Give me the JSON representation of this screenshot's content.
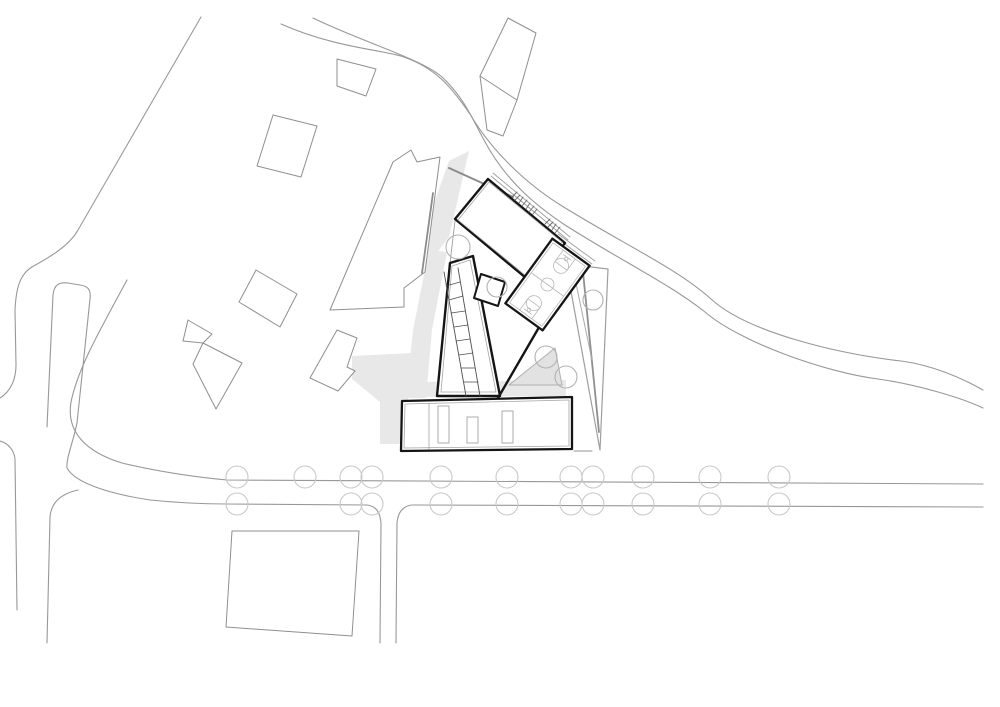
{
  "scene": {
    "kind": "architectural-site-plan",
    "width": 1000,
    "height": 707,
    "background": "#ffffff"
  },
  "palette": {
    "paper": "#ffffff",
    "road": "#989898",
    "context": "#8f8f8f",
    "wall_gray": "#8c8c8c",
    "kite": "#9e9e9e",
    "kite_heavy": "#8f8f8f",
    "kite_light": "#ababab",
    "shadow": "#e8e8e8",
    "plaza_fill": "#e2e2e2",
    "plaza_edge": "#b0b0b0",
    "dark": "#151515",
    "inner": "#a5a5a5",
    "marking": "#b8b8b8",
    "detail": "#4f4f4f",
    "stair": "#6a6a6a",
    "terrace": "#9d9d9d",
    "site_tree": "#b2b2b2",
    "street_tree": "#c9c9c9",
    "white": "#ffffff",
    "none": "none"
  },
  "layers": [
    {
      "kind": "polygon",
      "name": "shadow-upper-west",
      "points": "449,161 469,151 449,237 429,263 424,231",
      "fill": "shadow",
      "stroke": "none"
    },
    {
      "kind": "polygon",
      "name": "shadow-wing-west",
      "points": "429,250 447,252 432,330 426,398 406,398 413,330",
      "fill": "shadow",
      "stroke": "none"
    },
    {
      "kind": "polygon",
      "name": "shadow-lower-west",
      "points": "352,356 412,353 404,444 380,444 380,402 352,379",
      "fill": "shadow",
      "stroke": "none"
    },
    {
      "kind": "polygon",
      "name": "shadow-courtyard-band",
      "points": "415,382 566,380 566,396 413,397",
      "fill": "shadow",
      "stroke": "none"
    },
    {
      "kind": "path",
      "name": "road-northwest-boundary",
      "d": "M 201,17 L 78,230 C 68,248 44,260 32,267 C 19,275 16,290 15,310 L 16,365 C 16,380 10,392 0,398",
      "stroke": "road",
      "w": 1.1
    },
    {
      "kind": "path",
      "name": "road-main-outer-edge",
      "d": "M 281,24 C 335,48 385,50 404,57 C 437,69 450,86 470,114 C 492,152 528,185 562,206 C 625,245 678,269 711,299 C 748,333 840,354 901,361 C 932,365 962,378 983,390",
      "stroke": "road",
      "w": 1.1
    },
    {
      "kind": "path",
      "name": "road-main-inner-edge",
      "d": "M 313,18 C 362,42 425,60 443,78 C 464,98 472,118 484,140 C 505,180 535,205 565,225 C 625,263 668,283 705,312 C 740,342 824,372 878,379 C 914,384 960,397 983,408",
      "stroke": "road",
      "w": 1.1
    },
    {
      "kind": "path",
      "name": "street-north-edge",
      "d": "M 127,280 C 100,330 78,368 71,402 C 66,432 86,452 122,463 C 160,472 195,477 227,480 L 983,484",
      "stroke": "road",
      "w": 1.1
    },
    {
      "kind": "path",
      "name": "street-south-edge-west",
      "d": "M 77,423 C 73,443 66,458 67,468 C 75,483 110,494 150,500 C 180,503 205,504 227,504 L 367,505",
      "stroke": "road",
      "w": 1.1
    },
    {
      "kind": "path",
      "name": "street-south-edge-east",
      "d": "M 412,505 L 983,507",
      "stroke": "road",
      "w": 1.1
    },
    {
      "kind": "path",
      "name": "traffic-island",
      "d": "M 47,427 L 53,295 C 54,284 60,282 68,283 L 80,285 C 89,286 91,291 90,299 L 77,423",
      "stroke": "road",
      "w": 1.1
    },
    {
      "kind": "path",
      "name": "road-left-curb",
      "d": "M 0,441 C 8,443 14,450 15,459 L 17,610",
      "stroke": "road",
      "w": 1.1
    },
    {
      "kind": "path",
      "name": "road-southwest-branch",
      "d": "M 78,490 C 60,494 51,503 50,517 L 47,643",
      "stroke": "road",
      "w": 1.1
    },
    {
      "kind": "path",
      "name": "road-south-branch-west",
      "d": "M 367,505 C 376,506 380,512 381,523 L 380,643",
      "stroke": "road",
      "w": 1.1
    },
    {
      "kind": "path",
      "name": "road-south-branch-east",
      "d": "M 412,505 C 403,506 398,512 397,523 L 396,643",
      "stroke": "road",
      "w": 1.1
    },
    {
      "kind": "polygon",
      "name": "context-building-1",
      "points": "337,59 376,69 366,96 337,86",
      "fill": "white",
      "stroke": "context",
      "w": 1
    },
    {
      "kind": "polygon",
      "name": "context-building-2",
      "points": "273,115 317,126 301,177 257,166",
      "fill": "white",
      "stroke": "context",
      "w": 1
    },
    {
      "kind": "polygon",
      "name": "context-building-long",
      "points": "393,162 411,150 417,162 440,157 425,272 404,288 404,307 330,310",
      "fill": "white",
      "stroke": "context",
      "w": 1
    },
    {
      "kind": "polygon",
      "name": "context-building-4",
      "points": "256,270 297,294 280,327 239,302",
      "fill": "white",
      "stroke": "context",
      "w": 1
    },
    {
      "kind": "polygon",
      "name": "context-building-5a",
      "points": "188,320 212,334 203,343 183,341",
      "fill": "white",
      "stroke": "context",
      "w": 1
    },
    {
      "kind": "polygon",
      "name": "context-building-5b",
      "points": "203,343 242,363 216,409 193,364",
      "fill": "white",
      "stroke": "context",
      "w": 1
    },
    {
      "kind": "polygon",
      "name": "context-building-6",
      "points": "337,330 357,338 347,367 355,371 338,391 310,378",
      "fill": "white",
      "stroke": "context",
      "w": 1
    },
    {
      "kind": "polygon",
      "name": "context-building-tall",
      "points": "508,18 536,33 517,100 503,136 487,130 480,76",
      "fill": "white",
      "stroke": "context",
      "w": 1
    },
    {
      "kind": "line",
      "name": "context-building-tall-divider",
      "x1": 480,
      "y1": 76,
      "x2": 517,
      "y2": 100,
      "stroke": "context",
      "w": 1
    },
    {
      "kind": "polygon",
      "name": "context-parcel-south",
      "points": "232,531 359,531 352,636 226,627",
      "fill": "white",
      "stroke": "context",
      "w": 1
    },
    {
      "kind": "line",
      "name": "retaining-wall-north",
      "x1": 449,
      "y1": 168,
      "x2": 513,
      "y2": 197,
      "stroke": "wall_gray",
      "w": 2
    },
    {
      "kind": "line",
      "name": "retaining-wall-west",
      "x1": 433,
      "y1": 193,
      "x2": 422,
      "y2": 273,
      "stroke": "wall_gray",
      "w": 1.8
    },
    {
      "kind": "line",
      "name": "curb-tick-east",
      "x1": 574,
      "y1": 451,
      "x2": 592,
      "y2": 451,
      "stroke": "kite_light",
      "w": 1.2
    },
    {
      "kind": "polygon",
      "name": "terrain-kite",
      "points": "566,264 608,269 600,450",
      "fill": "none",
      "stroke": "kite",
      "w": 1.2
    },
    {
      "kind": "line",
      "name": "terrain-kite-inner-1",
      "x1": 583,
      "y1": 272,
      "x2": 599,
      "y2": 432,
      "stroke": "kite_heavy",
      "w": 1.8
    },
    {
      "kind": "line",
      "name": "terrain-kite-inner-2",
      "x1": 573,
      "y1": 269,
      "x2": 592,
      "y2": 360,
      "stroke": "kite_light",
      "w": 1
    },
    {
      "kind": "polygon",
      "name": "plaza-triangle",
      "points": "509,385 555,348 562,385",
      "fill": "plaza_fill",
      "stroke": "plaza_edge",
      "w": 1
    },
    {
      "kind": "line",
      "name": "terrace-edge-1",
      "x1": 491,
      "y1": 176,
      "x2": 568,
      "y2": 240,
      "stroke": "terrace",
      "w": 0.9
    },
    {
      "kind": "line",
      "name": "terrace-edge-2",
      "x1": 493,
      "y1": 173,
      "x2": 570,
      "y2": 237,
      "stroke": "terrace",
      "w": 0.9
    },
    {
      "kind": "line",
      "name": "terrace-edge-3",
      "x1": 555,
      "y1": 237,
      "x2": 592,
      "y2": 264,
      "stroke": "terrace",
      "w": 0.9
    },
    {
      "kind": "line",
      "name": "terrace-edge-4",
      "x1": 558,
      "y1": 234,
      "x2": 595,
      "y2": 261,
      "stroke": "terrace",
      "w": 0.9
    },
    {
      "kind": "line",
      "name": "courtyard-link-edge",
      "x1": 455,
      "y1": 221,
      "x2": 450,
      "y2": 263,
      "stroke": "terrace",
      "w": 0.9
    },
    {
      "kind": "polygon",
      "name": "hall-building",
      "points": "488,179 565,243 532,283 455,219",
      "fill": "white",
      "stroke": "dark",
      "w": 2.4
    },
    {
      "kind": "polygon",
      "name": "hall-building-inner-wall",
      "points": "489,182 562,242 531,280 458,220",
      "fill": "none",
      "stroke": "inner",
      "w": 0.8
    },
    {
      "kind": "polygon",
      "name": "wing-building",
      "points": "450,263 473,256 500,396 437,396",
      "fill": "white",
      "stroke": "dark",
      "w": 2.4
    },
    {
      "kind": "polygon",
      "name": "wing-building-inner-wall",
      "points": "452,266 470,260 496,392 441,392",
      "fill": "none",
      "stroke": "inner",
      "w": 0.8
    },
    {
      "kind": "line",
      "name": "ramp-rail-1",
      "x1": 444,
      "y1": 272,
      "x2": 466,
      "y2": 396,
      "stroke": "detail",
      "w": 0.9
    },
    {
      "kind": "line",
      "name": "ramp-rail-2",
      "x1": 458,
      "y1": 268,
      "x2": 480,
      "y2": 396,
      "stroke": "detail",
      "w": 0.9
    },
    {
      "kind": "line",
      "name": "ramp-rung",
      "x1": 446,
      "y1": 286,
      "x2": 460,
      "y2": 282,
      "stroke": "detail",
      "w": 0.8
    },
    {
      "kind": "line",
      "name": "ramp-rung",
      "x1": 449,
      "y1": 300,
      "x2": 463,
      "y2": 296,
      "stroke": "detail",
      "w": 0.8
    },
    {
      "kind": "line",
      "name": "ramp-rung",
      "x1": 451,
      "y1": 313,
      "x2": 465,
      "y2": 311,
      "stroke": "detail",
      "w": 0.8
    },
    {
      "kind": "line",
      "name": "ramp-rung",
      "x1": 454,
      "y1": 327,
      "x2": 468,
      "y2": 325,
      "stroke": "detail",
      "w": 0.8
    },
    {
      "kind": "line",
      "name": "ramp-rung",
      "x1": 456,
      "y1": 341,
      "x2": 470,
      "y2": 339,
      "stroke": "detail",
      "w": 0.8
    },
    {
      "kind": "line",
      "name": "ramp-rung",
      "x1": 459,
      "y1": 355,
      "x2": 473,
      "y2": 353,
      "stroke": "detail",
      "w": 0.8
    },
    {
      "kind": "line",
      "name": "ramp-rung",
      "x1": 461,
      "y1": 368,
      "x2": 475,
      "y2": 368,
      "stroke": "detail",
      "w": 0.8
    },
    {
      "kind": "line",
      "name": "ramp-rung",
      "x1": 464,
      "y1": 382,
      "x2": 478,
      "y2": 382,
      "stroke": "detail",
      "w": 0.8
    },
    {
      "kind": "polygon",
      "name": "entry-pavilion",
      "points": "481,274 505,282 498,306 474,298",
      "fill": "white",
      "stroke": "dark",
      "w": 2
    },
    {
      "kind": "polygon",
      "name": "lower-building",
      "points": "402,401 572,397 572,449 401,451",
      "fill": "white",
      "stroke": "dark",
      "w": 2.3
    },
    {
      "kind": "polygon",
      "name": "lower-building-inner-wall",
      "points": "405,404 569,400 569,446 404,448",
      "fill": "none",
      "stroke": "inner",
      "w": 0.8
    },
    {
      "kind": "line",
      "name": "lower-building-divider",
      "x1": 429,
      "y1": 403,
      "x2": 429,
      "y2": 449,
      "stroke": "inner",
      "w": 0.8
    },
    {
      "kind": "rect",
      "name": "skylight-1",
      "x": 438,
      "y": 406,
      "wd": 11,
      "h": 37,
      "fill": "white",
      "stroke": "kite_light",
      "w": 1
    },
    {
      "kind": "rect",
      "name": "skylight-2",
      "x": 467,
      "y": 417,
      "wd": 11,
      "h": 26,
      "fill": "white",
      "stroke": "kite_light",
      "w": 1
    },
    {
      "kind": "rect",
      "name": "skylight-3",
      "x": 502,
      "y": 411,
      "wd": 11,
      "h": 32,
      "fill": "white",
      "stroke": "kite_light",
      "w": 1
    },
    {
      "kind": "line",
      "name": "courtyard-wall",
      "x1": 538,
      "y1": 329,
      "x2": 498,
      "y2": 398,
      "stroke": "dark",
      "w": 2.4
    },
    {
      "kind": "line",
      "name": "stair-step",
      "x1": 512,
      "y1": 197,
      "x2": 517,
      "y2": 192,
      "stroke": "stair",
      "w": 0.9
    },
    {
      "kind": "line",
      "name": "stair-step",
      "x1": 515,
      "y1": 200,
      "x2": 520,
      "y2": 195,
      "stroke": "stair",
      "w": 0.9
    },
    {
      "kind": "line",
      "name": "stair-step",
      "x1": 519,
      "y1": 203,
      "x2": 523,
      "y2": 197,
      "stroke": "stair",
      "w": 0.9
    },
    {
      "kind": "line",
      "name": "stair-step",
      "x1": 522,
      "y1": 206,
      "x2": 527,
      "y2": 200,
      "stroke": "stair",
      "w": 0.9
    },
    {
      "kind": "line",
      "name": "stair-step",
      "x1": 526,
      "y1": 209,
      "x2": 530,
      "y2": 203,
      "stroke": "stair",
      "w": 0.9
    },
    {
      "kind": "line",
      "name": "stair-step",
      "x1": 529,
      "y1": 212,
      "x2": 534,
      "y2": 206,
      "stroke": "stair",
      "w": 0.9
    },
    {
      "kind": "line",
      "name": "stair-step",
      "x1": 533,
      "y1": 214,
      "x2": 537,
      "y2": 209,
      "stroke": "stair",
      "w": 0.9
    },
    {
      "kind": "line",
      "name": "stair-step",
      "x1": 545,
      "y1": 224,
      "x2": 550,
      "y2": 219,
      "stroke": "stair",
      "w": 0.9
    },
    {
      "kind": "line",
      "name": "stair-step",
      "x1": 548,
      "y1": 227,
      "x2": 553,
      "y2": 222,
      "stroke": "stair",
      "w": 0.9
    },
    {
      "kind": "line",
      "name": "stair-step",
      "x1": 552,
      "y1": 230,
      "x2": 556,
      "y2": 224,
      "stroke": "stair",
      "w": 0.9
    },
    {
      "kind": "line",
      "name": "stair-step",
      "x1": 555,
      "y1": 233,
      "x2": 560,
      "y2": 227,
      "stroke": "stair",
      "w": 0.9
    },
    {
      "kind": "group",
      "name": "basketball-court",
      "transform": "translate(547.5,284.5) rotate(36)",
      "items": [
        {
          "kind": "rect",
          "name": "court-slab",
          "x": -23,
          "y": -40,
          "wd": 46,
          "h": 80,
          "fill": "white",
          "stroke": "dark",
          "w": 2.3
        },
        {
          "kind": "rect",
          "name": "court-boundary",
          "x": -20,
          "y": -37,
          "wd": 40,
          "h": 74,
          "fill": "none",
          "stroke": "marking",
          "w": 0.8
        },
        {
          "kind": "line",
          "name": "court-halfway-line",
          "x1": -20,
          "y1": 0,
          "x2": 20,
          "y2": 0,
          "stroke": "marking",
          "w": 0.8
        },
        {
          "kind": "circle",
          "name": "court-center-circle",
          "cx": 0,
          "cy": 0,
          "r": 6.5,
          "fill": "none",
          "stroke": "marking",
          "w": 0.8
        },
        {
          "kind": "rect",
          "name": "court-key-north",
          "x": -7.5,
          "y": -37,
          "wd": 15,
          "h": 14,
          "fill": "none",
          "stroke": "marking",
          "w": 0.8
        },
        {
          "kind": "circle",
          "name": "court-freethrow-north",
          "cx": 0,
          "cy": -23,
          "r": 7.5,
          "fill": "none",
          "stroke": "marking",
          "w": 0.8
        },
        {
          "kind": "line",
          "name": "court-backboard-north",
          "x1": -4.5,
          "y1": -33.5,
          "x2": 4.5,
          "y2": -33.5,
          "stroke": "marking",
          "w": 0.8
        },
        {
          "kind": "circle",
          "name": "court-hoop-north",
          "cx": 0,
          "cy": -31.5,
          "r": 1.8,
          "fill": "none",
          "stroke": "marking",
          "w": 0.8
        },
        {
          "kind": "rect",
          "name": "court-key-south",
          "x": -7.5,
          "y": 23,
          "wd": 15,
          "h": 14,
          "fill": "none",
          "stroke": "marking",
          "w": 0.8
        },
        {
          "kind": "circle",
          "name": "court-freethrow-south",
          "cx": 0,
          "cy": 23,
          "r": 7.5,
          "fill": "none",
          "stroke": "marking",
          "w": 0.8
        },
        {
          "kind": "line",
          "name": "court-backboard-south",
          "x1": -4.5,
          "y1": 33.5,
          "x2": 4.5,
          "y2": 33.5,
          "stroke": "marking",
          "w": 0.8
        },
        {
          "kind": "circle",
          "name": "court-hoop-south",
          "cx": 0,
          "cy": 31.5,
          "r": 1.8,
          "fill": "none",
          "stroke": "marking",
          "w": 0.8
        }
      ]
    },
    {
      "kind": "circle",
      "name": "site-tree",
      "cx": 458,
      "cy": 247,
      "r": 12,
      "fill": "none",
      "stroke": "site_tree",
      "w": 1.1
    },
    {
      "kind": "circle",
      "name": "site-tree",
      "cx": 497,
      "cy": 287,
      "r": 10,
      "fill": "none",
      "stroke": "site_tree",
      "w": 1.1
    },
    {
      "kind": "circle",
      "name": "site-tree",
      "cx": 546,
      "cy": 357,
      "r": 11,
      "fill": "none",
      "stroke": "site_tree",
      "w": 1.1
    },
    {
      "kind": "circle",
      "name": "site-tree",
      "cx": 566,
      "cy": 377,
      "r": 11,
      "fill": "none",
      "stroke": "site_tree",
      "w": 1.1
    },
    {
      "kind": "circle",
      "name": "site-tree",
      "cx": 593,
      "cy": 300,
      "r": 10,
      "fill": "none",
      "stroke": "site_tree",
      "w": 1.1
    },
    {
      "kind": "tree-row",
      "name": "street-tree-row-north",
      "y": 477,
      "r": 11,
      "xs": [
        237,
        305,
        351,
        372,
        441,
        507,
        571,
        593,
        643,
        710,
        779
      ],
      "stroke": "street_tree",
      "w": 1.1
    },
    {
      "kind": "tree-row",
      "name": "street-tree-row-south",
      "y": 504,
      "r": 11,
      "xs": [
        237,
        351,
        372,
        441,
        507,
        571,
        593,
        643,
        710,
        779
      ],
      "stroke": "street_tree",
      "w": 1.1
    }
  ]
}
